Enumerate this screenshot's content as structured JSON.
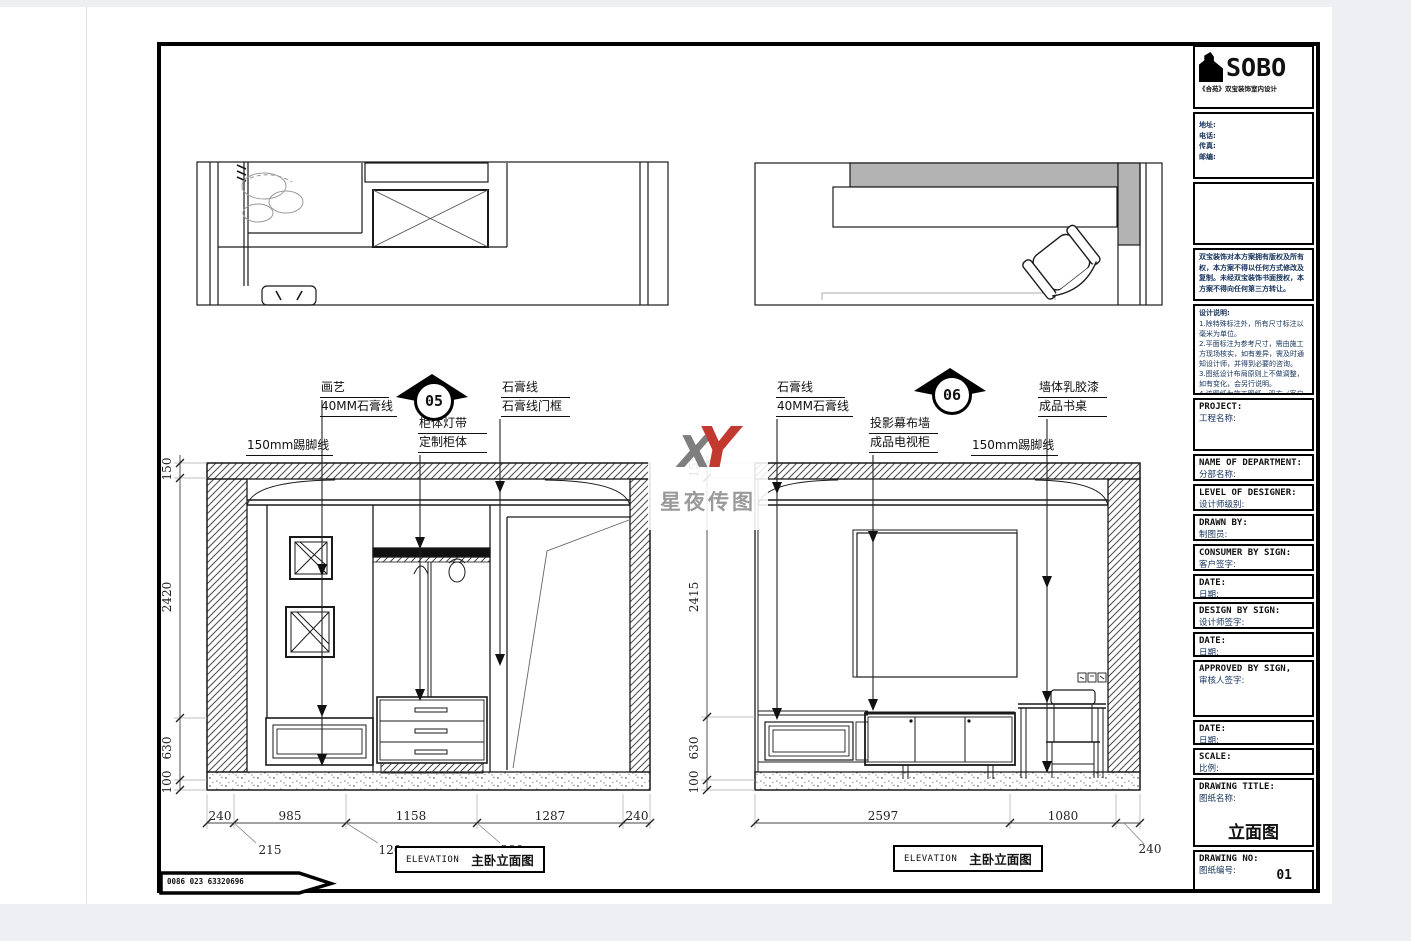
{
  "sheet": {
    "phone": "0086 023 63320696",
    "watermark": {
      "x": "X",
      "y": "Y",
      "text": "星夜传图"
    }
  },
  "markers": {
    "left": "05",
    "right": "06"
  },
  "left_elevation": {
    "labels": {
      "art": [
        "画艺",
        "40MM石膏线"
      ],
      "cabinet": [
        "柜体灯带",
        "定制柜体"
      ],
      "gypsum": [
        "石膏线",
        "石膏线门框"
      ],
      "skirting": "150mm踢脚线"
    },
    "dims_bottom": [
      "240",
      "985",
      "1158",
      "1287",
      "240"
    ],
    "dims_bottom_sub": [
      "215",
      "120",
      "200"
    ],
    "dims_side": [
      "150",
      "2420",
      "630",
      "100"
    ],
    "caption": {
      "en": "ELEVATION",
      "cn": "主卧立面图"
    }
  },
  "right_elevation": {
    "labels": {
      "gypsum": [
        "石膏线",
        "40MM石膏线"
      ],
      "projection": [
        "投影幕布墙",
        "成品电视柜"
      ],
      "skirting": "150mm踢脚线",
      "wall": [
        "墙体乳胶漆",
        "成品书桌"
      ]
    },
    "dims_bottom": [
      "2597",
      "1080"
    ],
    "dims_bottom_sub": [
      "240"
    ],
    "dims_side": [
      "155",
      "2415",
      "630",
      "100"
    ],
    "caption": {
      "en": "ELEVATION",
      "cn": "主卧立面图"
    }
  },
  "title_block": {
    "brand": "SOBO",
    "brand_sub": "《合苑》双宝装饰室内设计",
    "contact": [
      "地址:",
      "电话:",
      "传真:",
      "邮编:"
    ],
    "copyright": "双宝装饰对本方案拥有版权及所有权，本方案不得以任何方式修改及复制。未经双宝装饰书面授权，本方案不得向任何第三方转让。",
    "notes_title": "设计说明:",
    "notes": [
      "1.除特殊标注外，所有尺寸标注以毫米为单位。",
      "2.平面标注为参考尺寸，需由施工方现场核实，如有差异，需及时通知设计师，并得到必要的咨询。",
      "3.图纸设计布局原则上不做调整，如有变化，会另行说明。",
      "4.该图纸为施工图纸，双方（客户和设计师）签字认可后，方可指导施工。"
    ],
    "fields": [
      {
        "en": "PROJECT:",
        "cn": "工程名称:"
      },
      {
        "en": "NAME OF DEPARTMENT:",
        "cn": "分部名称:"
      },
      {
        "en": "LEVEL OF DESIGNER:",
        "cn": "设计师级别:"
      },
      {
        "en": "DRAWN BY:",
        "cn": "制图员:"
      },
      {
        "en": "CONSUMER BY SIGN:",
        "cn": "客户签字:"
      },
      {
        "en": "DATE:",
        "cn": "日期:"
      },
      {
        "en": "DESIGN BY SIGN:",
        "cn": "设计师签字:"
      },
      {
        "en": "DATE:",
        "cn": "日期:"
      },
      {
        "en": "APPROVED BY SIGN,",
        "cn": "审核人签字:"
      },
      {
        "en": "DATE:",
        "cn": "日期:"
      },
      {
        "en": "SCALE:",
        "cn": "比例:"
      },
      {
        "en": "DRAWING TITLE:",
        "cn": "图纸名称:"
      },
      {
        "en": "DRAWING NO:",
        "cn": "图纸编号:"
      }
    ],
    "drawing_title_value": "立面图",
    "drawing_no_value": "01"
  }
}
